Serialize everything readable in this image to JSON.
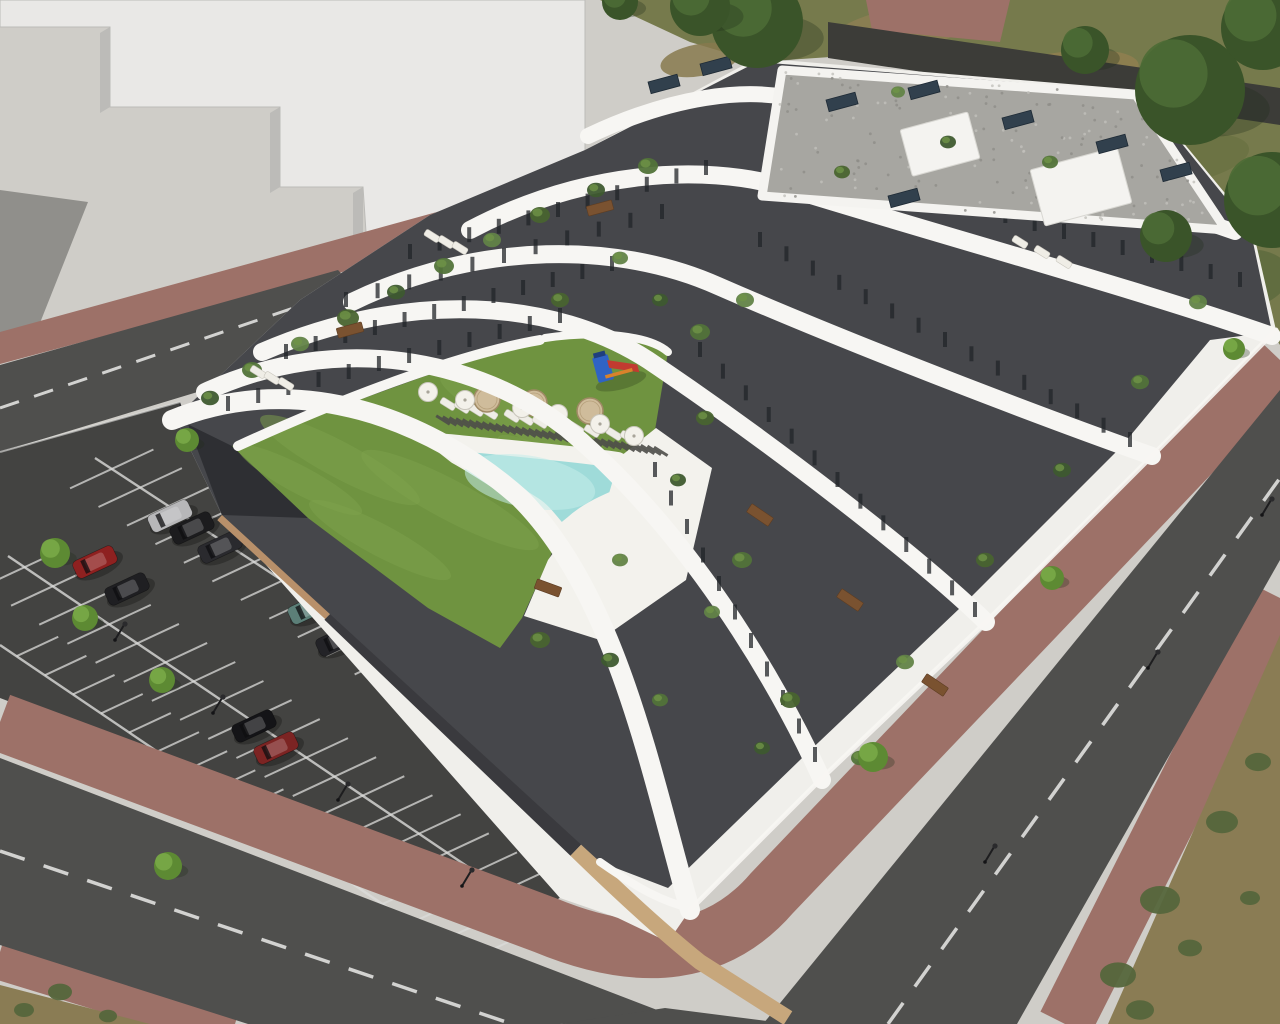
{
  "image": {
    "alt": "Aerial 3D architectural rendering of a white terraced apartment complex with courtyard lawn, free-form swimming pool, playground, parking lot with cars, and surrounding roads with red brick sidewalks"
  },
  "palette": {
    "bg_concrete": "#cfcdc8",
    "context_top": "#e9e8e6",
    "context_face": "#d3d2cf",
    "context_face_dark": "#bcbbb8",
    "context_shadow": "#908f8b",
    "grass_dry": "#767a4c",
    "path_dark": "#3c3c38",
    "sidewalk_brick": "#9d7168",
    "road_asphalt": "#4f4f4d",
    "road_line": "#e9e9e7",
    "parking_asphalt": "#434341",
    "parking_line": "#dcdcda",
    "wall_tan": "#b8906a",
    "wall_tan_light": "#c7a77c",
    "wall_dark": "#3a3a3e",
    "building_white": "#f0efeb",
    "band_white": "#f7f6f3",
    "facade_dark": "#46474b",
    "facade_tip_dark": "#2e2f33",
    "window_dark": "#222428",
    "roof_gravel": "#a7a6a1",
    "roof_edge": "#f4f3f0",
    "panel_navy": "#31404d",
    "lawn_green": "#6f9340",
    "lawn_light": "#7da24b",
    "pool_water": "#9fdbd9",
    "pool_light": "#c4ece9",
    "deck_white": "#f3f2ed",
    "slat_dark": "#4e4e49",
    "tree_bright": "#5d8a33",
    "tree_bright_hi": "#79a847",
    "tree_dark": "#3a5429",
    "tree_dark_hi": "#4d6b35",
    "shrub_green": "#55663c",
    "brush_tan": "#8a7c54",
    "umbrella_white": "#f3f1ea",
    "table_beige": "#cfbc9b",
    "lounger_white": "#efede6",
    "wood_brown": "#7a5230",
    "playground_blue": "#2f63c4",
    "playground_red": "#c23b30",
    "playground_orange": "#d9822b",
    "cast_shadow": "rgba(35,35,42,0.20)"
  },
  "scene": {
    "cars": [
      {
        "x": 170,
        "y": 516,
        "color": "#b7b7b9"
      },
      {
        "x": 192,
        "y": 528,
        "color": "#1c1c1e"
      },
      {
        "x": 220,
        "y": 547,
        "color": "#2a2a2e"
      },
      {
        "x": 95,
        "y": 562,
        "color": "#8e2120"
      },
      {
        "x": 127,
        "y": 589,
        "color": "#1f1f22"
      },
      {
        "x": 310,
        "y": 608,
        "color": "#5c7f78"
      },
      {
        "x": 338,
        "y": 640,
        "color": "#232327"
      },
      {
        "x": 254,
        "y": 726,
        "color": "#141417"
      },
      {
        "x": 276,
        "y": 748,
        "color": "#7c2423"
      }
    ],
    "trees_bright": [
      {
        "x": 55,
        "y": 553,
        "r": 15
      },
      {
        "x": 85,
        "y": 618,
        "r": 13
      },
      {
        "x": 162,
        "y": 680,
        "r": 13
      },
      {
        "x": 187,
        "y": 440,
        "r": 12
      },
      {
        "x": 168,
        "y": 866,
        "r": 14
      },
      {
        "x": 873,
        "y": 757,
        "r": 15
      },
      {
        "x": 1052,
        "y": 578,
        "r": 12
      },
      {
        "x": 1234,
        "y": 349,
        "r": 11
      }
    ],
    "trees_dark": [
      {
        "x": 757,
        "y": 22,
        "r": 46
      },
      {
        "x": 700,
        "y": 6,
        "r": 30
      },
      {
        "x": 620,
        "y": 2,
        "r": 18
      },
      {
        "x": 1085,
        "y": 50,
        "r": 24
      },
      {
        "x": 1190,
        "y": 90,
        "r": 55
      },
      {
        "x": 1263,
        "y": 28,
        "r": 42
      },
      {
        "x": 1272,
        "y": 200,
        "r": 48
      },
      {
        "x": 1166,
        "y": 236,
        "r": 26
      }
    ],
    "shrubs": [
      {
        "x": 1160,
        "y": 900,
        "r": 20
      },
      {
        "x": 1222,
        "y": 822,
        "r": 16
      },
      {
        "x": 1258,
        "y": 762,
        "r": 13
      },
      {
        "x": 1118,
        "y": 975,
        "r": 18
      },
      {
        "x": 1190,
        "y": 948,
        "r": 12
      },
      {
        "x": 1250,
        "y": 898,
        "r": 10
      },
      {
        "x": 1140,
        "y": 1010,
        "r": 14
      },
      {
        "x": 60,
        "y": 992,
        "r": 12
      },
      {
        "x": 24,
        "y": 1010,
        "r": 10
      },
      {
        "x": 108,
        "y": 1016,
        "r": 9
      }
    ],
    "parasols": [
      {
        "x": 465,
        "y": 400
      },
      {
        "x": 522,
        "y": 408
      },
      {
        "x": 558,
        "y": 414
      },
      {
        "x": 428,
        "y": 392
      },
      {
        "x": 600,
        "y": 424
      },
      {
        "x": 634,
        "y": 436
      }
    ],
    "round_tables": [
      {
        "x": 487,
        "y": 399
      },
      {
        "x": 534,
        "y": 403
      },
      {
        "x": 590,
        "y": 411
      }
    ],
    "pool_loungers": [
      {
        "x": 448,
        "y": 404
      },
      {
        "x": 462,
        "y": 407
      },
      {
        "x": 476,
        "y": 410
      },
      {
        "x": 490,
        "y": 413
      },
      {
        "x": 512,
        "y": 416
      },
      {
        "x": 526,
        "y": 419
      },
      {
        "x": 540,
        "y": 422
      },
      {
        "x": 560,
        "y": 425
      },
      {
        "x": 576,
        "y": 428
      },
      {
        "x": 592,
        "y": 431
      },
      {
        "x": 614,
        "y": 434
      },
      {
        "x": 628,
        "y": 437
      }
    ],
    "terrace_loungers": [
      {
        "x": 258,
        "y": 372
      },
      {
        "x": 272,
        "y": 378
      },
      {
        "x": 286,
        "y": 384
      },
      {
        "x": 432,
        "y": 236
      },
      {
        "x": 446,
        "y": 242
      },
      {
        "x": 460,
        "y": 248
      },
      {
        "x": 1020,
        "y": 242
      },
      {
        "x": 1042,
        "y": 252
      },
      {
        "x": 1064,
        "y": 262
      }
    ],
    "wood_tables": [
      {
        "x": 548,
        "y": 588,
        "a": 20
      },
      {
        "x": 760,
        "y": 515,
        "a": 34
      },
      {
        "x": 850,
        "y": 600,
        "a": 34
      },
      {
        "x": 935,
        "y": 685,
        "a": 34
      },
      {
        "x": 600,
        "y": 208,
        "a": -15
      },
      {
        "x": 350,
        "y": 330,
        "a": -15
      }
    ],
    "plants": [
      {
        "x": 210,
        "y": 398,
        "r": 9
      },
      {
        "x": 252,
        "y": 370,
        "r": 10
      },
      {
        "x": 300,
        "y": 344,
        "r": 9
      },
      {
        "x": 348,
        "y": 318,
        "r": 11
      },
      {
        "x": 396,
        "y": 292,
        "r": 9
      },
      {
        "x": 444,
        "y": 266,
        "r": 10
      },
      {
        "x": 492,
        "y": 240,
        "r": 9
      },
      {
        "x": 540,
        "y": 215,
        "r": 10
      },
      {
        "x": 596,
        "y": 190,
        "r": 9
      },
      {
        "x": 648,
        "y": 166,
        "r": 10
      },
      {
        "x": 620,
        "y": 258,
        "r": 8
      },
      {
        "x": 560,
        "y": 300,
        "r": 9
      },
      {
        "x": 660,
        "y": 300,
        "r": 8
      },
      {
        "x": 700,
        "y": 332,
        "r": 10
      },
      {
        "x": 745,
        "y": 300,
        "r": 9
      },
      {
        "x": 705,
        "y": 418,
        "r": 9
      },
      {
        "x": 678,
        "y": 480,
        "r": 8
      },
      {
        "x": 742,
        "y": 560,
        "r": 10
      },
      {
        "x": 712,
        "y": 612,
        "r": 8
      },
      {
        "x": 790,
        "y": 700,
        "r": 10
      },
      {
        "x": 762,
        "y": 748,
        "r": 8
      },
      {
        "x": 860,
        "y": 758,
        "r": 9
      },
      {
        "x": 905,
        "y": 662,
        "r": 9
      },
      {
        "x": 985,
        "y": 560,
        "r": 9
      },
      {
        "x": 1062,
        "y": 470,
        "r": 9
      },
      {
        "x": 1140,
        "y": 382,
        "r": 9
      },
      {
        "x": 1198,
        "y": 302,
        "r": 9
      },
      {
        "x": 842,
        "y": 172,
        "r": 8
      },
      {
        "x": 948,
        "y": 142,
        "r": 8
      },
      {
        "x": 1050,
        "y": 162,
        "r": 8
      },
      {
        "x": 898,
        "y": 92,
        "r": 7
      },
      {
        "x": 540,
        "y": 640,
        "r": 10
      },
      {
        "x": 610,
        "y": 660,
        "r": 9
      },
      {
        "x": 660,
        "y": 700,
        "r": 8
      },
      {
        "x": 620,
        "y": 560,
        "r": 8
      }
    ],
    "lamps": [
      {
        "x": 115,
        "y": 640
      },
      {
        "x": 213,
        "y": 713
      },
      {
        "x": 338,
        "y": 800
      },
      {
        "x": 462,
        "y": 886
      },
      {
        "x": 985,
        "y": 862
      },
      {
        "x": 1148,
        "y": 668
      },
      {
        "x": 1262,
        "y": 515
      }
    ],
    "roof_panels": [
      {
        "x": 826,
        "y": 100
      },
      {
        "x": 908,
        "y": 88
      },
      {
        "x": 1002,
        "y": 118
      },
      {
        "x": 1096,
        "y": 142
      },
      {
        "x": 888,
        "y": 196
      },
      {
        "x": 1160,
        "y": 170
      },
      {
        "x": 648,
        "y": 82
      },
      {
        "x": 700,
        "y": 64
      }
    ],
    "roof_boxes": [
      {
        "x": 900,
        "y": 130,
        "w": 70,
        "h": 48
      },
      {
        "x": 1030,
        "y": 170,
        "w": 90,
        "h": 58
      }
    ],
    "playground": {
      "x": 592,
      "y": 358
    }
  }
}
